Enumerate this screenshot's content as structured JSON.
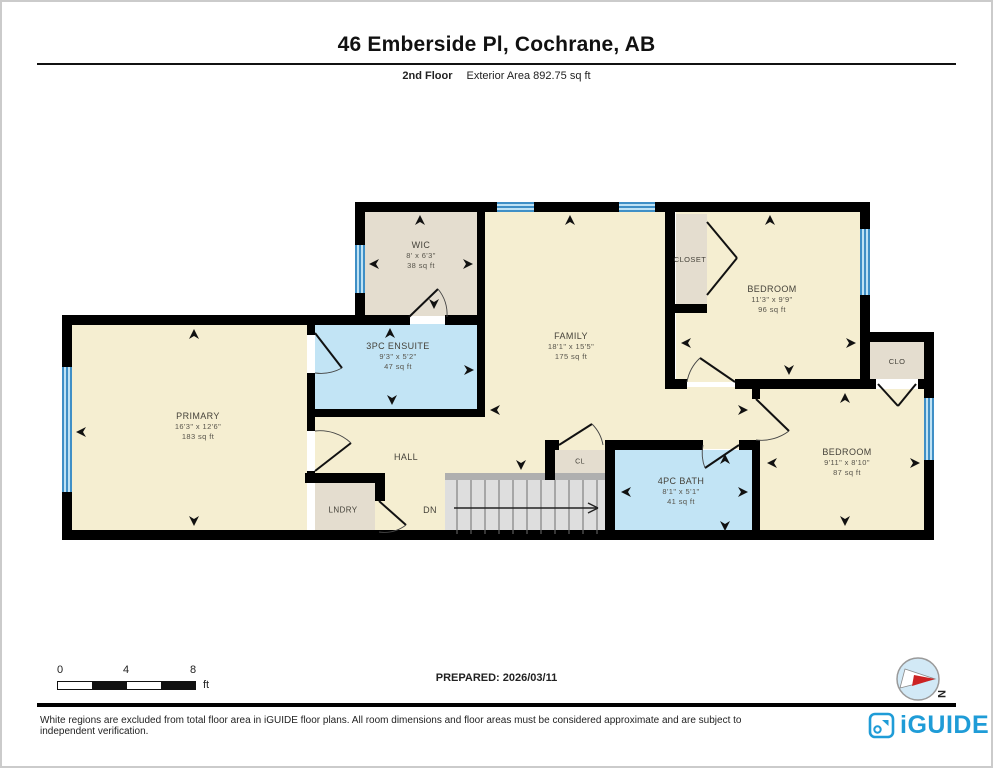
{
  "page": {
    "title": "46 Emberside Pl, Cochrane, AB",
    "floor": "2nd Floor",
    "area": "Exterior Area 892.75 sq ft",
    "prepared": "PREPARED: 2026/03/11",
    "compass_n": "N",
    "scale": {
      "ticks": [
        "0",
        "4",
        "8"
      ],
      "unit": "ft"
    },
    "disclaimer": "White regions are excluded from total floor area in iGUIDE floor plans. All room dimensions and floor areas must be considered approximate and are subject to independent verification.",
    "brand": "iGUIDE"
  },
  "colors": {
    "beige": "#F5EED1",
    "tan": "#E4DDCF",
    "blue": "#C2E4F5",
    "gray": "#DEDEDE",
    "rail": "#AFAFAF",
    "wall": "#000000",
    "window_frame": "#3F8FC6",
    "brand_blue": "#1F9CD7",
    "compass_red": "#CC2222"
  },
  "floorplan": {
    "fills": [
      {
        "n": "primary",
        "c": "beige",
        "r": [
          70,
          323,
          235,
          205
        ]
      },
      {
        "n": "hall",
        "c": "beige",
        "r": [
          313,
          412,
          170,
          121
        ]
      },
      {
        "n": "family",
        "c": "beige",
        "r": [
          483,
          210,
          182,
          263
        ]
      },
      {
        "n": "family-east",
        "c": "beige",
        "r": [
          665,
          385,
          93,
          62
        ]
      },
      {
        "n": "bedroom-1",
        "c": "beige",
        "r": [
          674,
          210,
          184,
          170
        ]
      },
      {
        "n": "bedroom-2",
        "c": "beige",
        "r": [
          758,
          387,
          164,
          146
        ]
      },
      {
        "n": "wic",
        "c": "tan",
        "r": [
          363,
          210,
          112,
          104
        ]
      },
      {
        "n": "closet-1",
        "c": "tan",
        "r": [
          674,
          212,
          31,
          90
        ]
      },
      {
        "n": "clo",
        "c": "tan",
        "r": [
          868,
          340,
          54,
          37
        ]
      },
      {
        "n": "cl",
        "c": "tan",
        "r": [
          553,
          448,
          50,
          25
        ]
      },
      {
        "n": "lndry",
        "c": "tan",
        "r": [
          313,
          481,
          60,
          51
        ]
      },
      {
        "n": "ensuite",
        "c": "blue",
        "r": [
          313,
          322,
          165,
          86
        ]
      },
      {
        "n": "bath",
        "c": "blue",
        "r": [
          613,
          448,
          137,
          85
        ]
      },
      {
        "n": "stairs",
        "c": "gray",
        "r": [
          443,
          478,
          160,
          55
        ]
      },
      {
        "n": "stair-rail",
        "c": "rail",
        "r": [
          443,
          471,
          160,
          7
        ]
      }
    ],
    "walls": [
      [
        353,
        200,
        515,
        10
      ],
      [
        353,
        200,
        10,
        123
      ],
      [
        60,
        313,
        303,
        10
      ],
      [
        60,
        313,
        10,
        225
      ],
      [
        60,
        528,
        872,
        10
      ],
      [
        858,
        200,
        10,
        187
      ],
      [
        858,
        330,
        74,
        10
      ],
      [
        922,
        330,
        10,
        208
      ],
      [
        475,
        200,
        8,
        215
      ],
      [
        305,
        407,
        178,
        8
      ],
      [
        305,
        313,
        8,
        20
      ],
      [
        305,
        371,
        8,
        58
      ],
      [
        305,
        469,
        8,
        12
      ],
      [
        303,
        471,
        80,
        10
      ],
      [
        373,
        481,
        10,
        18
      ],
      [
        353,
        313,
        55,
        10
      ],
      [
        443,
        313,
        40,
        10
      ],
      [
        663,
        210,
        10,
        172
      ],
      [
        663,
        302,
        42,
        9
      ],
      [
        663,
        377,
        22,
        10
      ],
      [
        733,
        377,
        141,
        10
      ],
      [
        916,
        377,
        16,
        10
      ],
      [
        750,
        377,
        8,
        20
      ],
      [
        750,
        438,
        8,
        100
      ],
      [
        603,
        438,
        98,
        10
      ],
      [
        737,
        438,
        21,
        10
      ],
      [
        603,
        438,
        10,
        100
      ],
      [
        543,
        438,
        14,
        10
      ],
      [
        543,
        438,
        10,
        40
      ]
    ],
    "windows": [
      {
        "o": "v",
        "r": [
          60,
          365,
          10,
          125
        ]
      },
      {
        "o": "v",
        "r": [
          353,
          243,
          10,
          48
        ]
      },
      {
        "o": "h",
        "r": [
          495,
          200,
          37,
          10
        ]
      },
      {
        "o": "h",
        "r": [
          617,
          200,
          36,
          10
        ]
      },
      {
        "o": "v",
        "r": [
          858,
          227,
          10,
          66
        ]
      },
      {
        "o": "v",
        "r": [
          922,
          396,
          10,
          62
        ]
      }
    ],
    "rooms": [
      {
        "id": "wic",
        "n": "WIC",
        "d": "8' x 6'3\"",
        "a": "38 sq ft",
        "x": 419,
        "y": 253
      },
      {
        "id": "ensuite",
        "n": "3PC ENSUITE",
        "d": "9'3\" x 5'2\"",
        "a": "47 sq ft",
        "x": 396,
        "y": 354
      },
      {
        "id": "family",
        "n": "FAMILY",
        "d": "18'1\" x 15'5\"",
        "a": "175 sq ft",
        "x": 569,
        "y": 344
      },
      {
        "id": "closet-1",
        "n": "CLOSET",
        "x": 688,
        "y": 258,
        "fs": 7.5
      },
      {
        "id": "bedroom-1",
        "n": "BEDROOM",
        "d": "11'3\" x 9'9\"",
        "a": "96 sq ft",
        "x": 770,
        "y": 297
      },
      {
        "id": "clo",
        "n": "CLO",
        "x": 895,
        "y": 360,
        "fs": 7.5
      },
      {
        "id": "primary",
        "n": "PRIMARY",
        "d": "16'3\" x 12'6\"",
        "a": "183 sq ft",
        "x": 196,
        "y": 424
      },
      {
        "id": "hall",
        "n": "HALL",
        "x": 404,
        "y": 455,
        "fs": 9
      },
      {
        "id": "lndry",
        "n": "LNDRY",
        "x": 341,
        "y": 509,
        "fs": 8
      },
      {
        "id": "dn",
        "n": "DN",
        "x": 428,
        "y": 508,
        "fs": 9
      },
      {
        "id": "cl",
        "n": "CL",
        "x": 578,
        "y": 460,
        "fs": 7
      },
      {
        "id": "bath",
        "n": "4PC BATH",
        "d": "8'1\" x 5'1\"",
        "a": "41 sq ft",
        "x": 679,
        "y": 489
      },
      {
        "id": "bedroom-2",
        "n": "BEDROOM",
        "d": "9'11\" x 8'10\"",
        "a": "87 sq ft",
        "x": 845,
        "y": 460
      }
    ],
    "doors": [
      {
        "id": "wic-door",
        "h": [
          407,
          315
        ],
        "t": [
          436,
          287
        ],
        "e": [
          445,
          315
        ],
        "s": 1
      },
      {
        "id": "ensuite-door",
        "h": [
          313,
          331
        ],
        "t": [
          340,
          366
        ],
        "e": [
          313,
          371
        ],
        "s": 1
      },
      {
        "id": "hall-door",
        "h": [
          313,
          469
        ],
        "t": [
          349,
          441
        ],
        "e": [
          313,
          429
        ],
        "s": 0
      },
      {
        "id": "lndry-door",
        "h": [
          377,
          499
        ],
        "t": [
          404,
          523
        ],
        "e": [
          377,
          530
        ],
        "s": 1
      },
      {
        "id": "bedroom-1-door",
        "h": [
          733,
          380
        ],
        "t": [
          698,
          356
        ],
        "e": [
          685,
          380
        ],
        "s": 0
      },
      {
        "id": "bedroom-2-door",
        "h": [
          754,
          397
        ],
        "t": [
          787,
          429
        ],
        "e": [
          754,
          438
        ],
        "s": 1
      },
      {
        "id": "bath-door",
        "h": [
          737,
          443
        ],
        "t": [
          703,
          466
        ],
        "e": [
          701,
          443
        ],
        "s": 1
      },
      {
        "id": "cl-door",
        "h": [
          557,
          443
        ],
        "t": [
          590,
          422
        ],
        "e": [
          601,
          443
        ],
        "s": 1
      }
    ],
    "lines": [
      [
        705,
        220,
        735,
        256
      ],
      [
        735,
        256,
        705,
        293
      ],
      [
        876,
        382,
        896,
        404
      ],
      [
        914,
        382,
        896,
        404
      ]
    ],
    "stairs": {
      "treads": {
        "x1": 455,
        "x2": 595,
        "step": 14,
        "y1": 478,
        "y2": 532
      },
      "arrow": [
        [
          452,
          506,
          596,
          506
        ],
        [
          596,
          506,
          586,
          501
        ],
        [
          596,
          506,
          586,
          511
        ]
      ]
    },
    "arrows": [
      [
        418,
        213,
        "up"
      ],
      [
        367,
        262,
        "left"
      ],
      [
        471,
        262,
        "right"
      ],
      [
        432,
        307,
        "down"
      ],
      [
        388,
        326,
        "up"
      ],
      [
        472,
        368,
        "right"
      ],
      [
        390,
        403,
        "down"
      ],
      [
        568,
        213,
        "up"
      ],
      [
        488,
        408,
        "left"
      ],
      [
        746,
        408,
        "right"
      ],
      [
        519,
        468,
        "down"
      ],
      [
        768,
        213,
        "up"
      ],
      [
        679,
        341,
        "left"
      ],
      [
        854,
        341,
        "right"
      ],
      [
        787,
        373,
        "down"
      ],
      [
        843,
        391,
        "up"
      ],
      [
        765,
        461,
        "left"
      ],
      [
        918,
        461,
        "right"
      ],
      [
        843,
        524,
        "down"
      ],
      [
        723,
        452,
        "up"
      ],
      [
        619,
        490,
        "left"
      ],
      [
        746,
        490,
        "right"
      ],
      [
        723,
        529,
        "down"
      ],
      [
        192,
        327,
        "up"
      ],
      [
        74,
        430,
        "left"
      ],
      [
        192,
        524,
        "down"
      ]
    ]
  }
}
